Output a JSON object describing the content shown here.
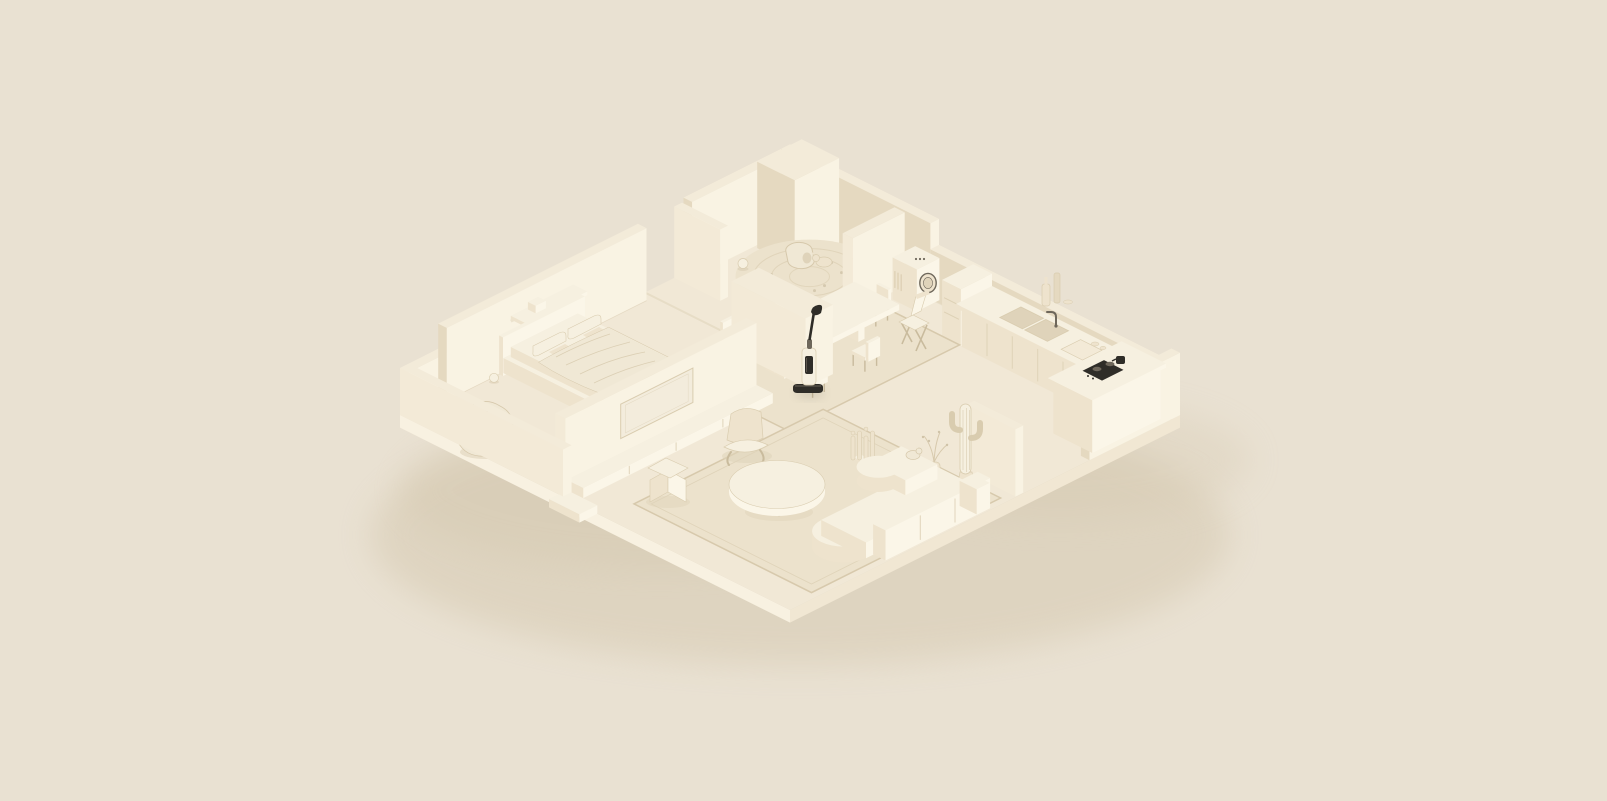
{
  "scene": {
    "title": "Monochrome cream isometric apartment cutaway - 3D clay render",
    "description": "A single open-plan apartment rendered as a pale cream diorama floating on a beige background. Bedroom at the left, living room at the front, dining area in the middle, kitchen at the right, laundry nook at the back. A dark cordless wet-dry stick vacuum leaning on a storage block is the only dark focal object.",
    "canvas": {
      "width": 1607,
      "height": 801
    },
    "background": "#e9e1d2",
    "palette": {
      "bg": "#e9e1d2",
      "floorTop": "#f1e8d6",
      "slabFront": "#f8f1e1",
      "slabRight": "#f1e7d3",
      "wallTop": "#f3ebd9",
      "wallBright": "#f9f3e3",
      "wallMid": "#e5d9c0",
      "wallLight": "#f3ead7",
      "floorShade": "#dfd3ba",
      "rug": "#ece2cc",
      "rugLine": "#d7c9ac",
      "cloth": "#f0e8d5",
      "clothLine": "#d6c8ab",
      "tvPanel": "#f3ecdc",
      "furnTop": "#f6f0e0",
      "furnLeft": "#eee3cd",
      "furnRight": "#fbf6e8",
      "dark": "#2f2d28",
      "darkMid": "#6e675b",
      "legs": "#c9bb9d",
      "shadow": "#d0c3a8",
      "line": "#d9ccaf"
    },
    "rooms": [
      "bedroom",
      "living-room",
      "dining-area",
      "kitchen",
      "laundry-corner"
    ],
    "focal_point": "cordless wet-dry vacuum leaning against the central storage block",
    "objects": [
      {
        "id": "groundShadow",
        "name": "ground-shadow",
        "label": "soft shadow cast by the apartment slab"
      },
      {
        "id": "slab",
        "name": "floor-slab",
        "label": "apartment floor slab"
      },
      {
        "id": "entryStep",
        "name": "entry-step",
        "label": "entry step outside the front parapet gap"
      },
      {
        "id": "backLeftTall",
        "name": "back-left-tall-wall",
        "label": "tall rear wall with doorway panel"
      },
      {
        "id": "backRight",
        "name": "back-right-wall",
        "label": "rear right wall with chimney block"
      },
      {
        "id": "bedroomWall",
        "name": "bedroom-back-wall",
        "label": "bedroom headboard wall with floating shelf"
      },
      {
        "id": "roundRug",
        "name": "round-play-rug",
        "label": "round braided rug with pet, toys and ball"
      },
      {
        "id": "laundryPartition",
        "name": "laundry-partition",
        "label": "freestanding laundry partition"
      },
      {
        "id": "washer",
        "name": "washing-machine",
        "label": "front-loading washing machine"
      },
      {
        "id": "kitchen",
        "name": "kitchen-counter",
        "label": "kitchen cabinets, double sink, faucet and shelf bottles"
      },
      {
        "id": "rightParapet",
        "name": "right-parapet-wall",
        "label": "low wall at the right corner"
      },
      {
        "id": "island",
        "name": "kitchen-island",
        "label": "kitchen island with dark cooktop"
      },
      {
        "id": "diningRug",
        "name": "dining-rug",
        "label": "rug under the dining set"
      },
      {
        "id": "diningSet",
        "name": "dining-set",
        "label": "dining table with six chairs"
      },
      {
        "id": "foldChair",
        "name": "folding-chair",
        "label": "wooden folding chair by the rug"
      },
      {
        "id": "storageBlock",
        "name": "storage-block",
        "label": "freestanding storage volume"
      },
      {
        "id": "vacuum",
        "name": "wet-dry-vacuum",
        "label": "cordless wet-dry stick vacuum, dark accent focal object"
      },
      {
        "id": "bed",
        "name": "bed",
        "label": "platform bed with pillows and draped blanket"
      },
      {
        "id": "beanbag",
        "name": "beanbag-chair",
        "label": "crumpled lounge beanbag"
      },
      {
        "id": "tvWall",
        "name": "tv-partition-wall",
        "label": "media partition wall with TV panel and low ledge"
      },
      {
        "id": "livingRug",
        "name": "living-room-rug",
        "label": "large area rug in the living zone"
      },
      {
        "id": "loungeChair",
        "name": "lounge-chair",
        "label": "sculpted lounge chair"
      },
      {
        "id": "slatSculpture",
        "name": "slat-sculpture",
        "label": "decorative slat sculpture"
      },
      {
        "id": "coffeeTable",
        "name": "coffee-table",
        "label": "round coffee table"
      },
      {
        "id": "dividerScreen",
        "name": "divider-screen",
        "label": "freestanding divider screen"
      },
      {
        "id": "cactus",
        "name": "cactus-plant",
        "label": "potted saguaro cactus"
      },
      {
        "id": "branchVase",
        "name": "branch-vase",
        "label": "vase with dry branches"
      },
      {
        "id": "sofa",
        "name": "modular-sofa",
        "label": "curved modular sofa with a cat on it"
      },
      {
        "id": "zigzagChair",
        "name": "magazine-chair",
        "label": "folded zigzag chair"
      },
      {
        "id": "frontParapet",
        "name": "front-parapet-wall",
        "label": "low parapet along the front-left edge"
      }
    ]
  }
}
